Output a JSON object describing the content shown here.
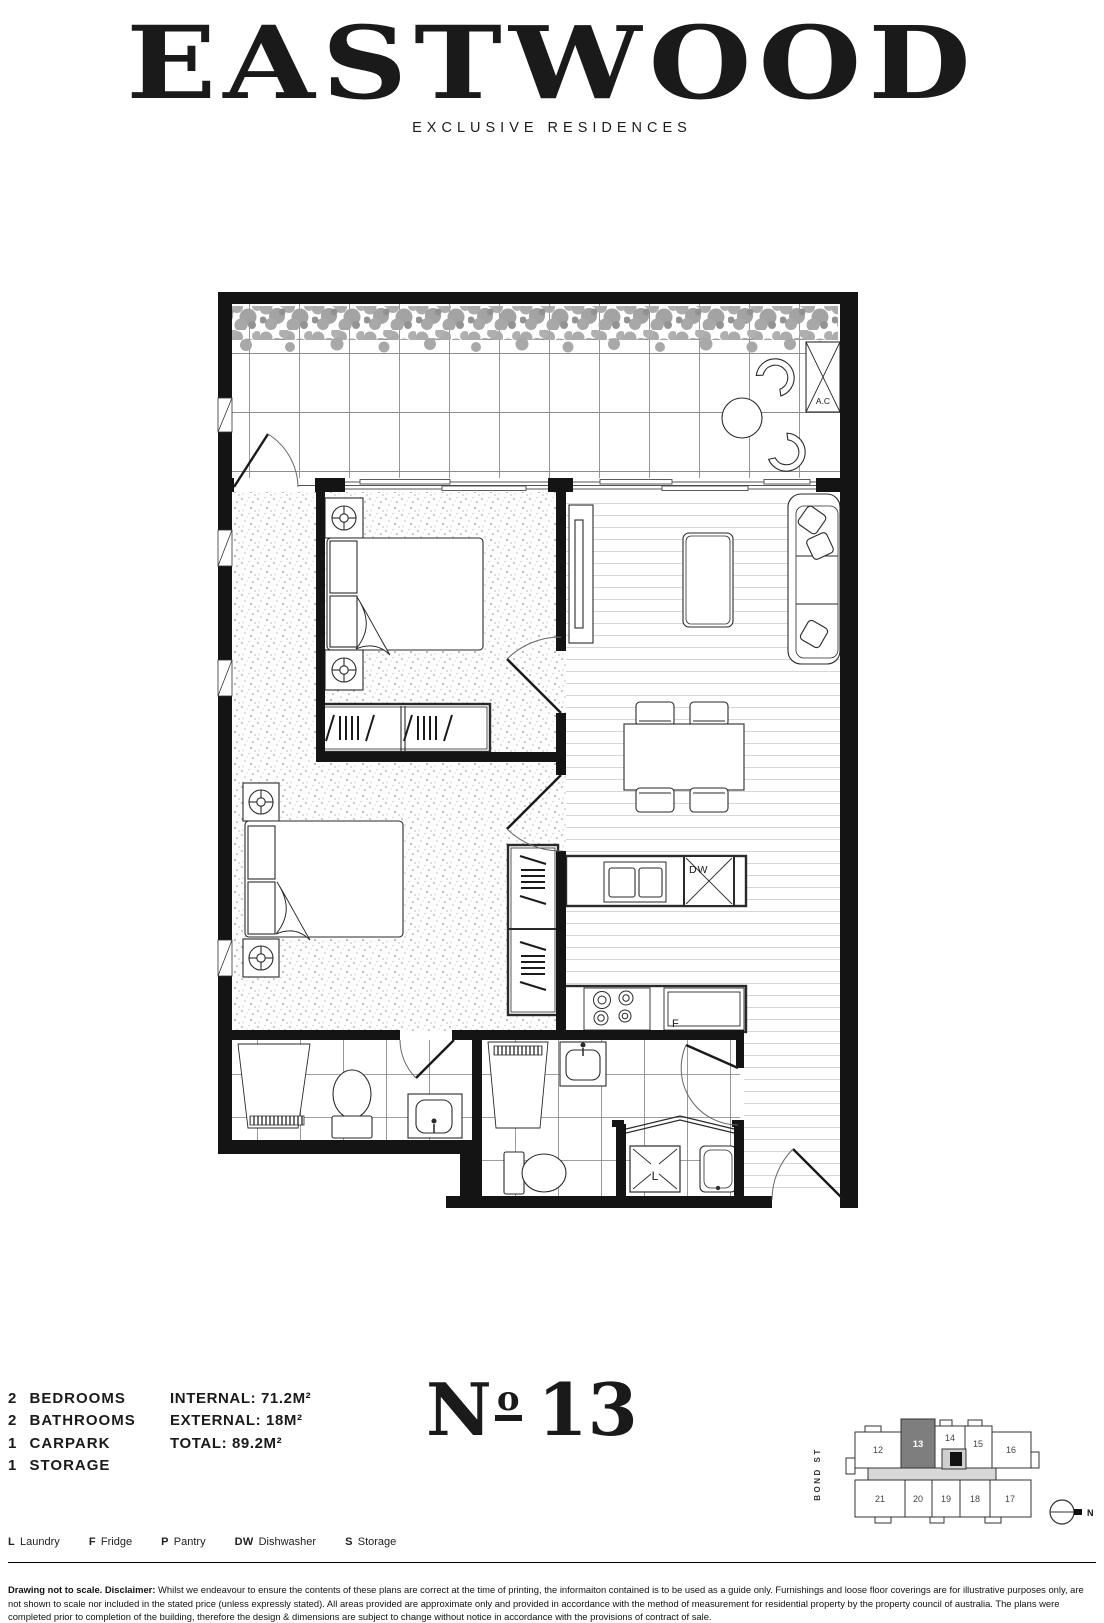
{
  "header": {
    "title": "EASTWOOD",
    "subtitle": "EXCLUSIVE RESIDENCES"
  },
  "summary": {
    "items": [
      "2 BEDROOMS",
      "2 BATHROOMS",
      "1 CARPARK",
      "1 STORAGE"
    ]
  },
  "areas": {
    "items": [
      "INTERNAL: 71.2M²",
      "EXTERNAL: 18M²",
      "TOTAL: 89.2M²"
    ]
  },
  "unit": {
    "prefix": "N",
    "ordinal": "o",
    "number": "13"
  },
  "plan": {
    "labels": {
      "ac": "A.C",
      "dishwasher": "DW",
      "fridge": "F",
      "laundry": "L"
    }
  },
  "keyplan": {
    "street": "BOND ST",
    "north": "N",
    "units_top": [
      "12",
      "13",
      "14",
      "15",
      "16"
    ],
    "units_bottom": [
      "21",
      "20",
      "19",
      "18",
      "17"
    ],
    "highlighted_unit": "13"
  },
  "legend": {
    "items": [
      {
        "key": "L",
        "label": "Laundry"
      },
      {
        "key": "F",
        "label": "Fridge"
      },
      {
        "key": "P",
        "label": "Pantry"
      },
      {
        "key": "DW",
        "label": "Dishwasher"
      },
      {
        "key": "S",
        "label": "Storage"
      }
    ]
  },
  "footer": {
    "disclaimer_lead": "Drawing not to scale. Disclaimer:",
    "disclaimer_body": " Whilst we endeavour to ensure the contents of these plans are correct at the time of printing, the informaiton contained is to be used as a guide only. Furnishings and loose floor coverings are for illustrative purposes only, are not shown to scale nor included in the stated price (unless expressly stated). All areas provided are approximate only and provided in accordance with the method of measurement for residential property by the property council of australia. The plans were completed prior to completion of the building, therefore the design & dimensions are subject to change without notice in accordance with the provisions of contract of sale."
  },
  "colors": {
    "ink": "#1a1a1a",
    "wall": "#141414",
    "plants": "#a9a9a9",
    "corridor_fill": "#d8d8d8",
    "unit_highlight": "#7e7e7e"
  }
}
